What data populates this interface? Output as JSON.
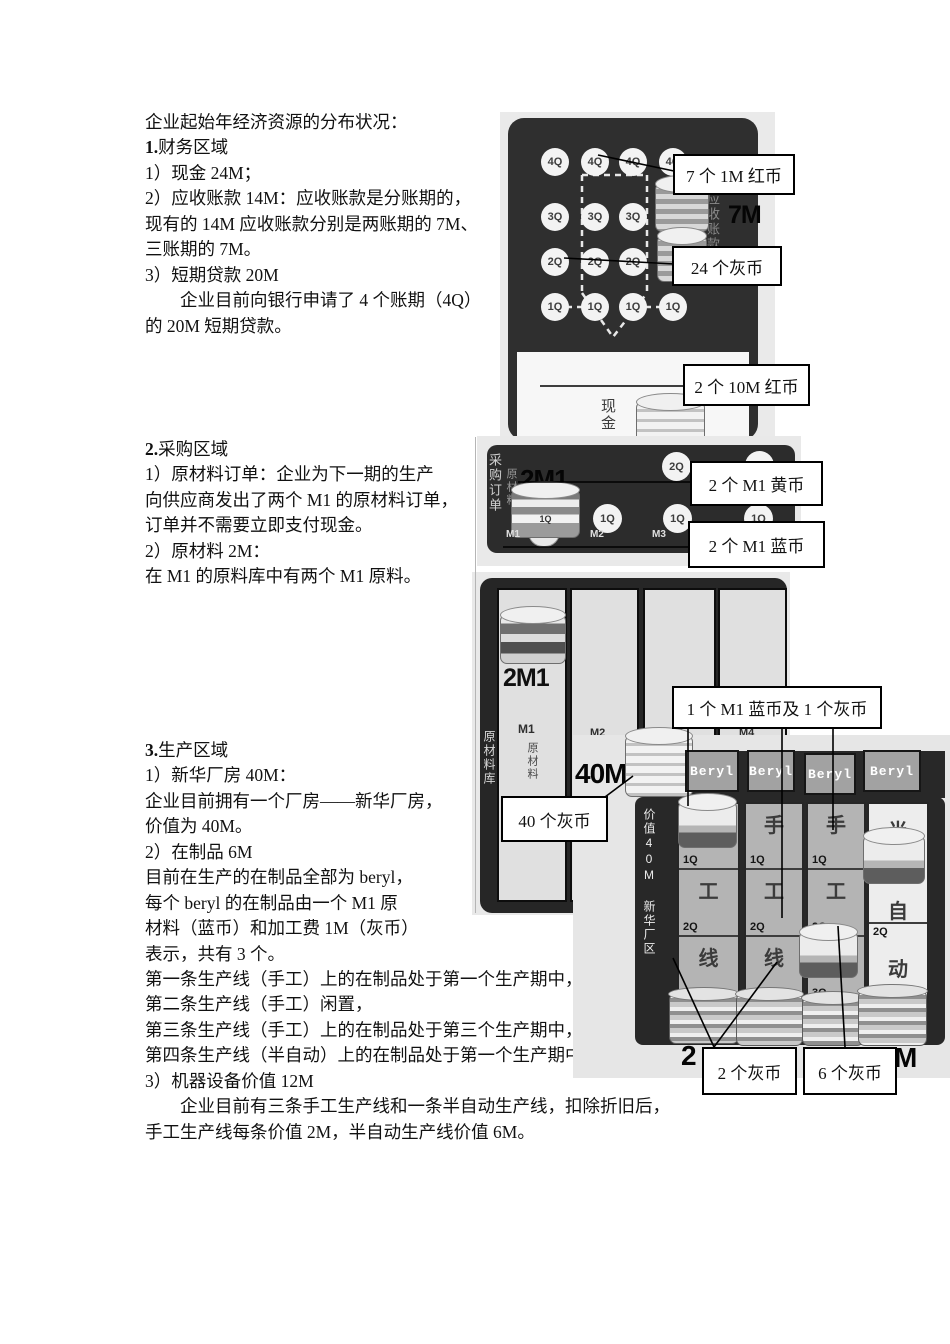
{
  "document": {
    "sections": [
      {
        "heading": "企业起始年经济资源的分布状况：",
        "num": "1.",
        "name": "财务区域",
        "lines": [
          "1）现金 24M；",
          "2）应收账款 14M：应收账款是分账期的，",
          "现有的 14M 应收账款分别是两账期的 7M、",
          "三账期的 7M。",
          "3）短期贷款 20M",
          "企业目前向银行申请了 4 个账期（4Q）",
          "的 20M 短期贷款。"
        ]
      },
      {
        "num": "2.",
        "name": "采购区域",
        "lines": [
          "1）原材料订单：企业为下一期的生产",
          "向供应商发出了两个 M1 的原材料订单，",
          "订单并不需要立即支付现金。",
          "2）原材料 2M：",
          "在 M1 的原料库中有两个 M1 原料。"
        ]
      },
      {
        "num": "3.",
        "name": "生产区域",
        "lines": [
          "1）新华厂房 40M：",
          "企业目前拥有一个厂房——新华厂房，",
          "价值为 40M。",
          "2）在制品 6M",
          "目前在生产的在制品全部为 beryl，",
          "每个 beryl 的在制品由一个 M1 原",
          "材料（蓝币）和加工费 1M（灰币）",
          "表示，共有 3 个。",
          "第一条生产线（手工）上的在制品处于第一个生产期中，",
          "第二条生产线（手工）闲置，",
          "第三条生产线（手工）上的在制品处于第三个生产期中，",
          "第四条生产线（半自动）上的在制品处于第一个生产期中。",
          "3）机器设备价值 12M",
          "企业目前有三条手工生产线和一条半自动生产线，扣除折旧后，",
          "手工生产线每条价值 2M，半自动生产线价值 6M。"
        ]
      }
    ]
  },
  "finance": {
    "row_labels": [
      "4Q",
      "3Q",
      "2Q",
      "1Q"
    ],
    "amount_7m": "7M",
    "receivables_label": "应收账款",
    "cash_label": "现金",
    "callout_red1m": "7 个 1M 红币",
    "callout_gray24": "24 个灰币",
    "callout_red10m": "2 个 10M 红币"
  },
  "procurement": {
    "side_label": "采购订单",
    "material_label": "原材料",
    "qty": "2M1",
    "coin_band": "1Q",
    "q2": "2Q",
    "q1": "1Q",
    "m1": "M1",
    "m2": "M2",
    "m3": "M3",
    "callout_yellow": "2 个 M1 黄币",
    "callout_blue": "2 个 M1 蓝币"
  },
  "warehouse": {
    "side_label": "原材料库",
    "qty": "2M1",
    "m1": "M1",
    "material_label": "原材料",
    "m2": "M2",
    "m3": "M3",
    "m4": "M4"
  },
  "production": {
    "value": "40M",
    "value_side": "价值40M",
    "zone_side": "新华厂区",
    "card": "Beryl",
    "manual_chars": [
      "手",
      "工",
      "线"
    ],
    "q_labels": [
      "1Q",
      "2Q",
      "3Q"
    ],
    "semi_chars": [
      "半",
      "自",
      "动"
    ],
    "semi_q": "2Q",
    "bottom_left": "2",
    "bottom_right": "M",
    "callout_gray40": "40 个灰币",
    "callout_wip": "1 个 M1 蓝币及 1 个灰币",
    "callout_gray2": "2 个灰币",
    "callout_gray6": "6 个灰币"
  }
}
